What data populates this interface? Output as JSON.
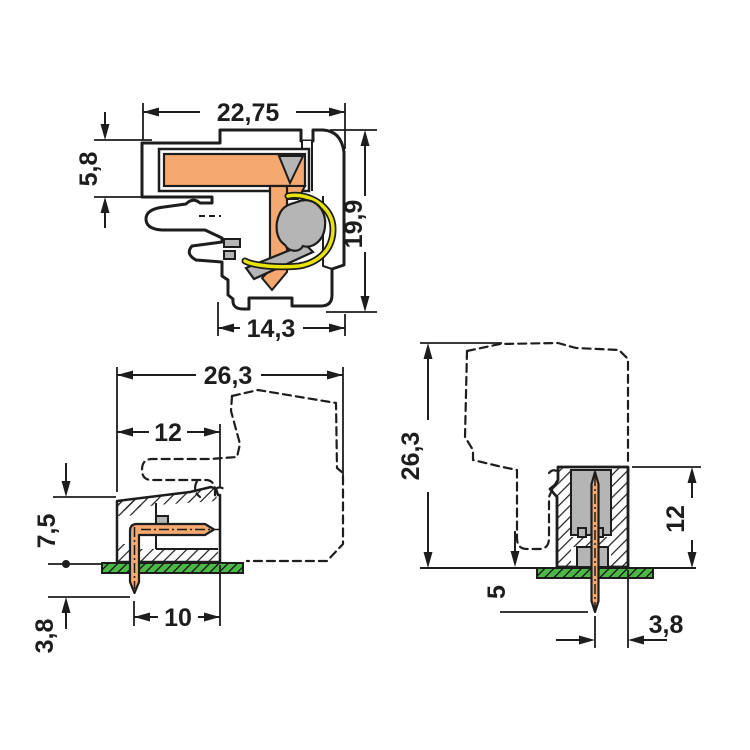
{
  "page": {
    "background": "#ffffff",
    "kind": "technical dimension drawing"
  },
  "views": {
    "section": {
      "label": "cross-section of angled female connector",
      "dims": {
        "width_top": "22,75",
        "entry_height": "5,8",
        "height_right": "19,9",
        "width_bottom": "14,3"
      }
    },
    "side": {
      "label": "side view of angled PCB header with mating connector dashed",
      "dims": {
        "width_total": "26,3",
        "housing_width": "12",
        "housing_height": "7,5",
        "pin_below_board": "3,8",
        "pin_center_to_face": "10"
      }
    },
    "front": {
      "label": "front view of vertical PCB header with mating connector dashed",
      "dims": {
        "height_total": "26,3",
        "housing_height": "12",
        "pin_below_board": "5",
        "pin_center_to_edge": "3,8"
      }
    }
  },
  "colors": {
    "housing_gray": "#b5b5b5",
    "contact_copper": "#f5a86f",
    "spring_yellow": "#e8e409",
    "pcb_green": "#4db848",
    "line_dark": "#1d1d1d"
  }
}
